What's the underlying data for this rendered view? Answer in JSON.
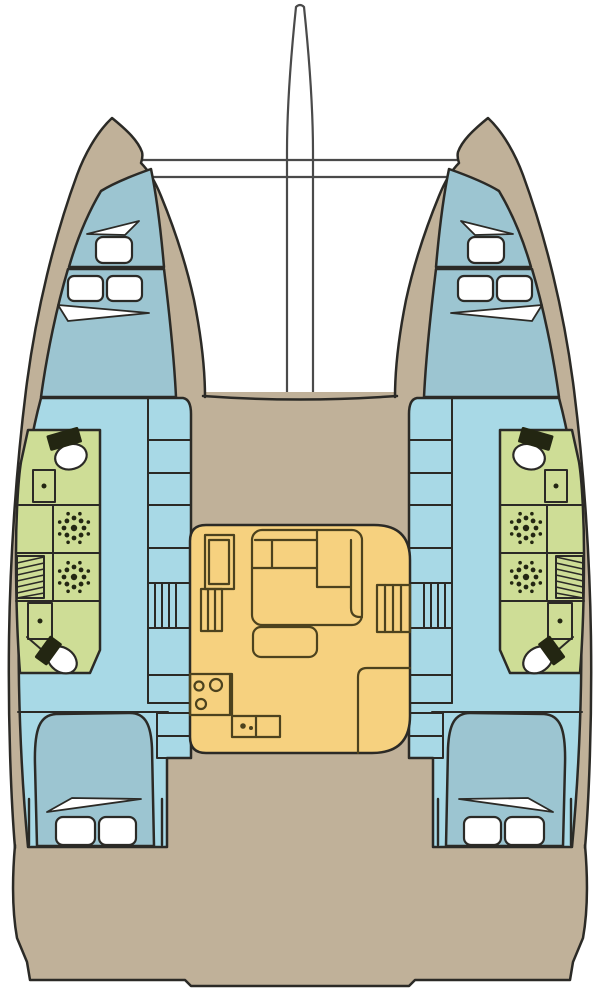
{
  "diagram": {
    "title": "catamaran-deck-plan",
    "type": "boat-floor-plan",
    "view": "top-down layout of a sailing catamaran"
  },
  "colors": {
    "background": "#ffffff",
    "outline": "#2b2a26",
    "deck": "#c0b199",
    "interior_floor": "#a8d9e6",
    "berth": "#9cc5d1",
    "bathroom": "#cedd96",
    "salon": "#f6d17f",
    "white": "#ffffff",
    "fixture_dark": "#232612",
    "fixture_line": "#30351a",
    "salon_line": "#4c421e",
    "rigging": "#4a4a4a"
  },
  "vessel": {
    "hulls": [
      {
        "id": "port",
        "cabins": [
          "forepeak berth",
          "forward double berth",
          "aft double berth"
        ],
        "bathrooms": [
          "forward head with toilet and washbasin",
          "two shower compartments",
          "aft head with toilet and washbasin"
        ],
        "other": [
          "inboard storage cabinets",
          "companionway steps",
          "wardrobe"
        ]
      },
      {
        "id": "starboard",
        "cabins": [
          "forepeak berth",
          "forward double berth",
          "aft double berth"
        ],
        "bathrooms": [
          "forward head with toilet and washbasin",
          "two shower compartments",
          "aft head with toilet and washbasin"
        ],
        "other": [
          "inboard storage cabinets",
          "companionway steps",
          "wardrobe"
        ]
      }
    ],
    "salon": {
      "features": [
        "chart table",
        "L-shaped sofa",
        "coffee table",
        "galley stove with three burners",
        "double sink unit",
        "galley cabinet",
        "port steps",
        "starboard steps"
      ]
    },
    "deck": {
      "features": [
        "bowsprit",
        "forward crossbeams",
        "trampoline",
        "foredeck",
        "aft cockpit deck"
      ]
    }
  }
}
